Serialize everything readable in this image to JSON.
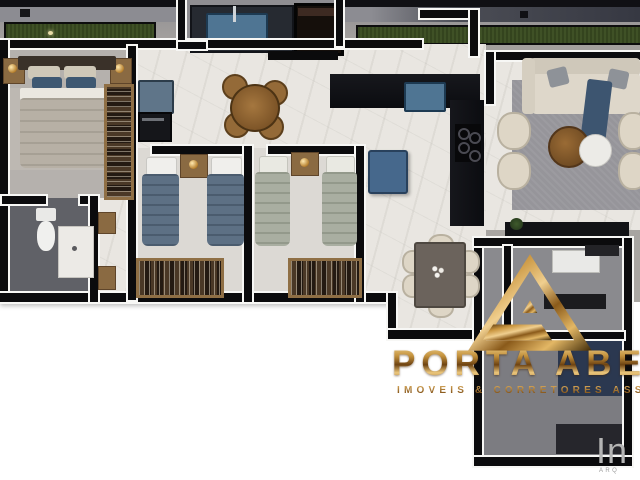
{
  "brand": {
    "name": "PORTA ABERTA",
    "tagline": "IMOVEIS & CORRETORES ASSOCIADOS",
    "logo_letter": "A",
    "logo_icon": "gold-triangle-a-logo"
  },
  "watermark": {
    "text": "In",
    "subtext": "ARQ"
  },
  "palette": {
    "gold": "#c08a3e",
    "gold_light": "#f0cf8f",
    "gold_dark": "#5a3a10",
    "wall": "#0b0b0d",
    "wall_outline": "#f7f7f5",
    "grass": "#3f5126",
    "marble_floor": "#e9e6e1",
    "gray_floor": "#b5b1ad",
    "bath_floor": "#606167",
    "accent_blue": "#4f7593",
    "navy": "#2b3850",
    "sofa_cream": "#ded6c6",
    "wood": "#8a6a42",
    "rug_gray": "#96959a",
    "bed_blue": "#5d7084",
    "bed_green": "#a9aea1"
  }
}
